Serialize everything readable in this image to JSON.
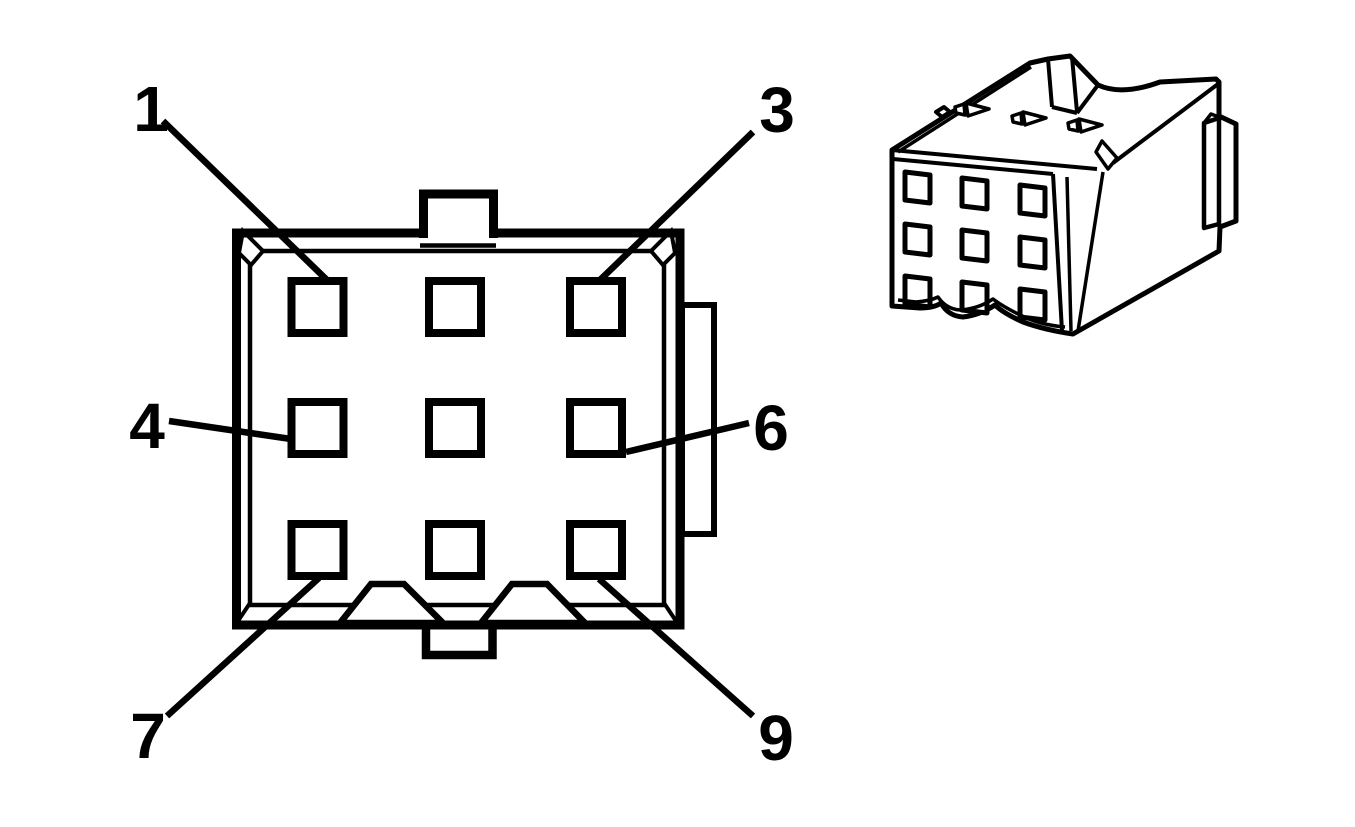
{
  "figure": {
    "background_color": "#ffffff",
    "line_color": "#000000",
    "face_view_caption": "",
    "iso_view_caption": ""
  },
  "connector": {
    "cavity_rows": 3,
    "cavity_cols": 3,
    "total_cavities": 9
  },
  "pin_labels": [
    {
      "text": "1",
      "position": "top-left"
    },
    {
      "text": "3",
      "position": "top-right"
    },
    {
      "text": "4",
      "position": "middle-left"
    },
    {
      "text": "6",
      "position": "middle-right"
    },
    {
      "text": "7",
      "position": "bottom-left"
    },
    {
      "text": "9",
      "position": "bottom-right"
    }
  ]
}
